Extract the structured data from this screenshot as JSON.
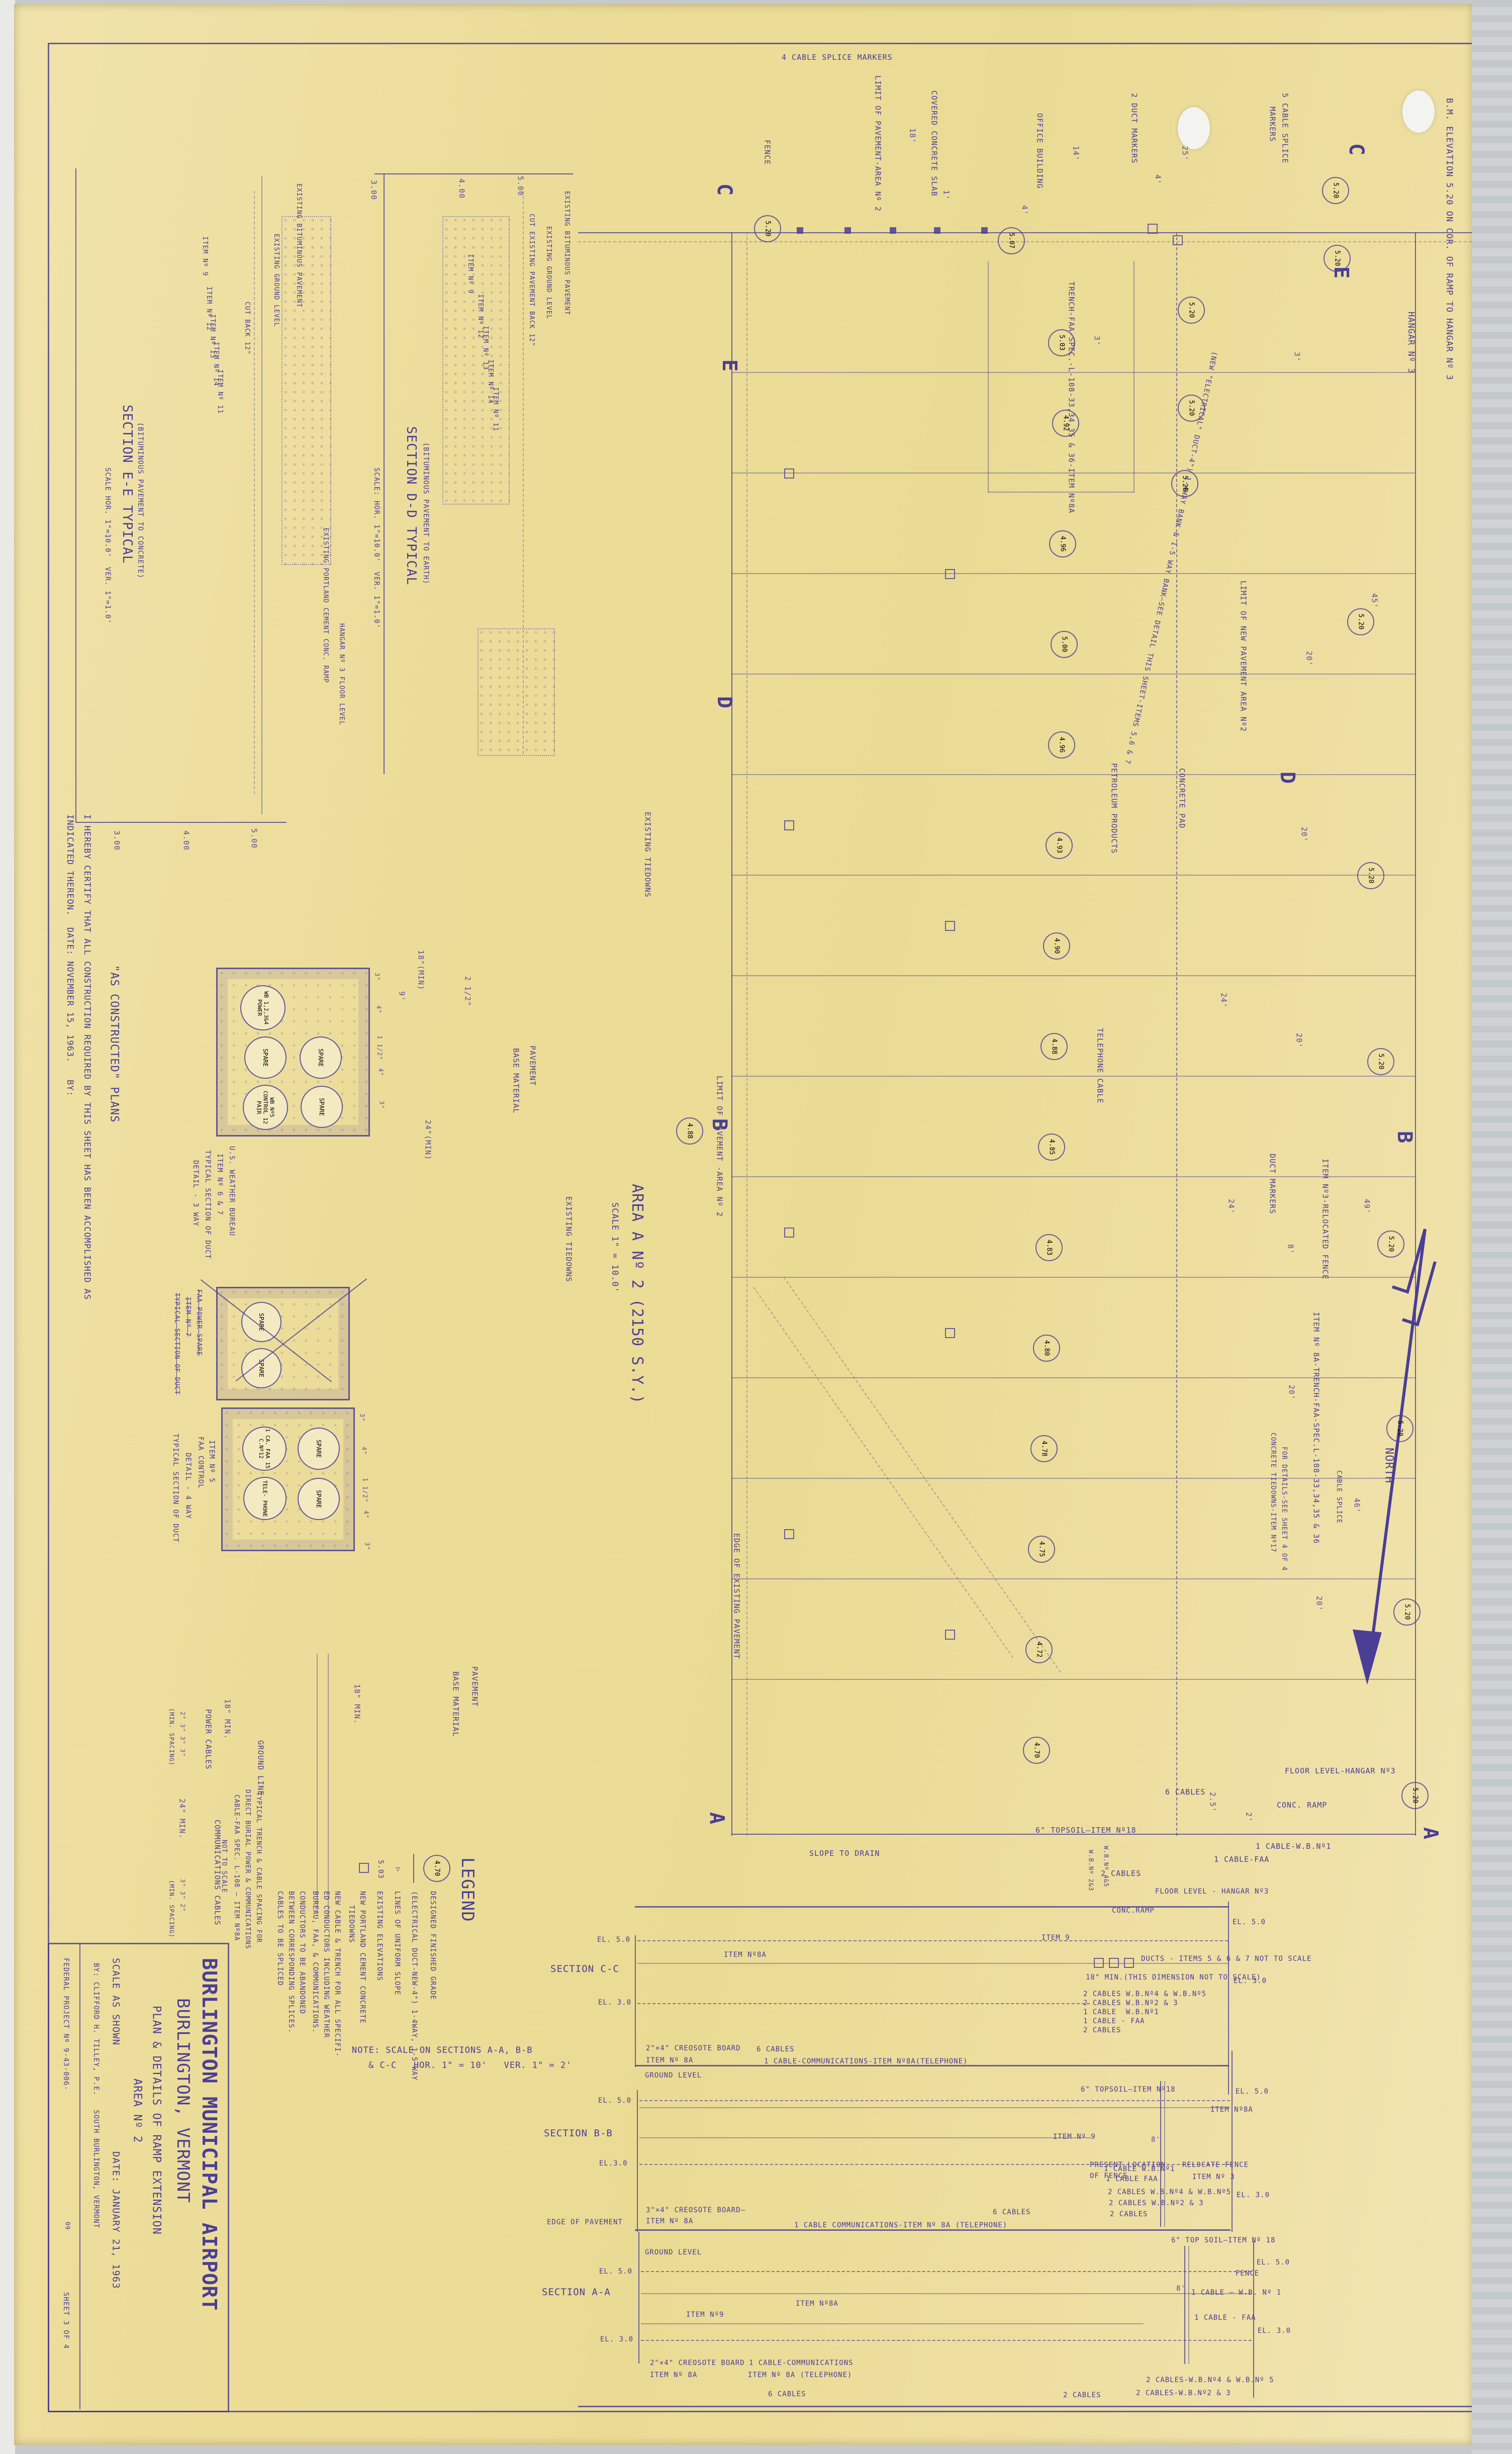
{
  "colors": {
    "paper": "#ecdc99",
    "ink": "#4a3e96",
    "scanner": "#c6c9cb"
  },
  "tb": {
    "airport": "BURLINGTON MUNICIPAL AIRPORT",
    "city": "BURLINGTON, VERMONT",
    "plan_title": "PLAN & DETAILS OF RAMP EXTENSION",
    "area": "AREA Nº 2",
    "scale": "SCALE AS SHOWN",
    "date": "DATE: JANUARY 21, 1963",
    "by": "BY: CLIFFORD H. TILLEY, P.E.   SOUTH BURLINGTON, VERMONT",
    "federal": "FEDERAL PROJECT Nº 9-43-006-",
    "fed2": "09",
    "sheet": "SHEET 3 OF 4"
  },
  "cert": {
    "line1": "I HEREBY CERTIFY THAT ALL CONSTRUCTION REQUIRED BY THIS SHEET HAS BEEN ACCOMPLISHED AS",
    "line2": "INDICATED THEREON.  DATE: NOVEMBER 15, 1963.   BY:",
    "stamp": "\"AS CONSTRUCTED\" PLANS"
  },
  "see": {
    "title": "SECTION E-E TYPICAL",
    "sub": "(BITUMINOUS PAVEMENT TO CONCRETE)",
    "scale": "SCALE HOR. 1\"=10.0'  VER. 1\"=1.0'",
    "ticks": [
      "3.00",
      "4.00",
      "5.00"
    ],
    "bitpav": "EXISTING BITUMINOUS PAVEMENT",
    "cutback": "CUT BACK 12\"",
    "ground": "EXISTING GROUND LEVEL",
    "i9": "ITEM Nº 9",
    "i12": "ITEM Nº 12",
    "i13": "ITEM Nº 13",
    "i14": "ITEM Nº 14",
    "i11": "ITEM Nº 11",
    "pccramp": "EXISTING PORTLAND CEMENT CONC. RAMP",
    "hangarfloor": "HANGAR Nº 3 FLOOR LEVEL"
  },
  "sdd": {
    "title": "SECTION D-D TYPICAL",
    "sub": "(BITUMINOUS PAVEMENT TO EARTH)",
    "scale": "SCALE: HOR. 1\"=10.0'  VER. 1\"=1.0'",
    "ticks": [
      "3.00",
      "4.00",
      "5.00"
    ],
    "bitpav": "EXISTING BITUMINOUS PAVEMENT",
    "cutpav": "CUT EXISTING PAVEMENT BACK 12\"",
    "ground": "EXISTING GROUND LEVEL",
    "i9": "ITEM Nº 9",
    "i12": "ITEM Nº 12",
    "i13": "ITEM Nº 13",
    "i14": "ITEM Nº 14",
    "i11": "ITEM Nº 11"
  },
  "ducts": {
    "wb": {
      "t1": "U.S. WEATHER BUREAU",
      "t2": "ITEM Nº 6 & 7",
      "t3": "TYPICAL SECTION OF DUCT",
      "t4": "DETAIL - 3 WAY",
      "c1": "WB 1,2,3&4 POWER",
      "c2": "SPARE",
      "c3": "WB Nº5 CONTROL 12 PAIR",
      "c4": "SPARE",
      "c5": "SPARE"
    },
    "fp": {
      "t1": "FAA POWER-SPARE",
      "t2": "ITEM Nº 7",
      "t3": "TYPICAL SECTION OF DUCT",
      "c1": "SPARE",
      "c2": "SPARE"
    },
    "fc": {
      "t1": "FAA CONTROL",
      "t2": "ITEM Nº 5",
      "t3": "TYPICAL SECTION OF DUCT",
      "t4": "DETAIL - 4 WAY",
      "c1": "1 CA. FAA 15 C.Nº12",
      "c2": "TELE- PHONE",
      "c3": "SPARE",
      "c4": "SPARE"
    },
    "pavement": "PAVEMENT",
    "base": "BASE MATERIAL",
    "min18": "18\"(MIN)",
    "min24": "24\"(MIN)",
    "d9": "9'",
    "d2h": "2 1/2\"",
    "d3": "3\"",
    "d4": "4\"",
    "d15": "1 1/2\""
  },
  "trench": {
    "power": "POWER CABLES",
    "comm": "COMMUNICATIONS CABLES",
    "ground": "GROUND LINE",
    "min18": "18\" MIN.",
    "min24": "24\" MIN.",
    "sp1": "2\" 3\" 3\" 3\"",
    "spn": "(MIN. SPACING)",
    "sp2": "3\" 3\" 2\"",
    "cap1": "TYPICAL TRENCH & CABLE SPACING FOR",
    "cap2": "DIRECT BURIAL POWER & COMMUNICATIONS",
    "cap3": "CABLE-FAA SPEC. L-108 — ITEM Nº8A",
    "cap4": "NOT TO SCALE",
    "pavement": "PAVEMENT",
    "base": "BASE MATERIAL"
  },
  "legend": {
    "title": "LEGEND",
    "i1s": "4.70",
    "i1": "DESIGNED FINISHED GRADE",
    "i2": "(ELECTRICAL DUCT-NEW-4\") 1-4WAY, 1-5 WAY",
    "i3": "LINES OF UNIFORM SLOPE",
    "i3s": "▷",
    "i4s": "5.03",
    "i4": "EXISTING ELEVATIONS",
    "i5a": "NEW PORTLAND CEMENT CONCRETE",
    "i5b": "TIEDOWNS",
    "i6a": "NEW CABLE & TRENCH FOR ALL SPECIFI-",
    "i6b": "ED CONDUCTORS INCLUDING WEATHER",
    "i6c": "BUREAU, FAA, & COMMUNICATIONS.",
    "i7a": "CONDUCTORS TO BE ABANDONED",
    "i7b": "BETWEEN CORRESPONDING SPLICES.",
    "i7c": "CABLES TO BE SPLICED",
    "note1": "NOTE: SCALE ON SECTIONS A-A, B-B",
    "note2": "& C-C   HOR. 1\" = 10'   VER. 1\" = 2'"
  },
  "scc": {
    "name": "SECTION C-C",
    "el5l": "EL. 5.0",
    "el3l": "EL. 3.0",
    "el5r": "EL. 5.0",
    "el3r": "EL. 3.0",
    "item8a": "ITEM Nº8A",
    "creo": "2\"×4\" CREOSOTE BOARD",
    "creo2": "ITEM Nº 8A",
    "c6": "6 CABLES",
    "comm": "1 CABLE-COMMUNICATIONS-ITEM Nº8A(TELEPHONE)",
    "item9": "ITEM 9",
    "ramp": "CONC.RAMP",
    "floor": "FLOOR LEVEL - HANGAR Nº3",
    "ducts": "DUCTS - ITEMS 5 & 6 & 7 NOT TO SCALE",
    "min18": "18\" MIN.(THIS DIMENSION NOT TO SCALE)",
    "k1": "2 CABLES W.B.Nº4 & W.B.Nº5",
    "k2": "2 CABLES W.B.Nº2 & 3",
    "k3": "1 CABLE  W.B.Nº1",
    "k4": "1 CABLE - FAA",
    "k5": "2 CABLES",
    "wb23": "W.B.Nº 2&3",
    "wb45": "W.B.Nº 4&5"
  },
  "sbb": {
    "name": "SECTION B-B",
    "ground": "GROUND LEVEL",
    "el5l": "EL. 5.0",
    "el3l": "EL.3.0",
    "el5r": "EL. 5.0",
    "el3r": "EL. 3.0",
    "topsoil": "6\" TOPSOIL—ITEM Nº18",
    "item8a": "ITEM Nº8A",
    "item9": "ITEM Nº 9",
    "d8": "8'",
    "pres1": "PRESENT LOCATION",
    "pres2": "OF FENCE",
    "rel1": "RELOCATE FENCE",
    "rel2": "ITEM Nº 3",
    "creo": "3\"×4\" CREOSOTE BOARD—",
    "creo2": "ITEM Nº 8A",
    "comm": "1 CABLE COMMUNICATIONS-ITEM Nº 8A (TELEPHONE)",
    "c6": "6 CABLES",
    "k1": "1 CABLE W.B.Nº1",
    "k2": "1 CABLE FAA",
    "k3": "2 CABLES W.B.Nº4 & W.B.Nº5",
    "k4": "2 CABLES W.B.Nº2 & 3",
    "k5": "2 CABLES"
  },
  "saa": {
    "name": "SECTION A-A",
    "edge": "EDGE OF PAVEMENT",
    "ground": "GROUND LEVEL",
    "el5l": "EL. 5.0",
    "el3l": "EL. 3.0",
    "el5r": "EL. 5.0",
    "el3r": "EL. 3.0",
    "item9": "ITEM Nº9",
    "item8a": "ITEM Nº8A",
    "creo": "2\"×4\" CREOSOTE BOARD",
    "creo2": "ITEM Nº 8A",
    "comm1": "1 CABLE-COMMUNICATIONS",
    "comm2": "ITEM Nº 8A (TELEPHONE)",
    "c6": "6 CABLES",
    "topsoil": "6\" TOP SOIL—ITEM Nº 18",
    "fence": "FENCE",
    "d8": "8'",
    "kwb1": "1 CABLE — W.B. Nº 1",
    "kfaa": "1 CABLE - FAA",
    "k45": "2 CABLES-W.B.Nº4 & W.B.Nº 5",
    "k23": "2 CABLES-W.B.Nº2 & 3",
    "k2": "2 CABLES"
  },
  "plan": {
    "title": "AREA A Nº 2 (2150 S.Y.)",
    "scale": "SCALE 1\" = 10.0'",
    "splice4": "4 CABLE SPLICE MARKERS",
    "splice5a": "5 CABLE SPLICE",
    "splice5b": "MARKERS",
    "bm": "B.M. ELEVATION 5.20 ON COR. OF RAMP TO HANGAR Nº 3",
    "hangar": "HANGAR Nº 3",
    "north": "NORTH",
    "cuts": {
      "c": "C",
      "e": "E",
      "d": "D",
      "b": "B",
      "a": "A"
    },
    "labels": {
      "fence": "FENCE",
      "limit_pav": "LIMIT OF PAVEMENT-AREA Nº 2",
      "limit_pav2": "LIMIT OF PAVEMENT -AREA Nº 2",
      "limit_new": "LIMIT OF NEW PAVEMENT AREA Nº2",
      "slab": "COVERED CONCRETE SLAB",
      "office": "OFFICE BUILDING",
      "ductm2": "2 DUCT MARKERS",
      "ductm": "DUCT MARKERS",
      "trench": "TRENCH-FAA-SPEC.-L-108-33,34,35 & 36-ITEM Nº8A",
      "newduct": "(NEW \"ELECTRICAL\" DUCT-4\") 1-4WAY BANK & 1-5 WAY BANK—SEE DETAIL THIS SHEET-ITEMS 5,6 & 7",
      "item8a_trench": "ITEM Nº 8A-TRENCH-FAA-SPEC.L-108-33,34,35 & 36",
      "petroleum": "PETROLEUM PRODUCTS",
      "pad": "CONCRETE PAD",
      "relocated": "ITEM Nº3-RELOCATED FENCE",
      "tiedowns": "EXISTING TIEDOWNS",
      "tiedowns2": "EXISTING TIEDOWNS",
      "edge_exist": "EDGE OF EXISTING PAVEMENT",
      "telcable": "TELEPHONE CABLE",
      "ctiedowns": "CONCRETE TIEDOWNS-ITEM Nº17",
      "ctiedowns2": "FOR DETAILS-SEE SHEET 4 OF 4",
      "csplice": "CABLE SPLICE",
      "slope": "SLOPE TO DRAIN",
      "topsoil": "6\" TOPSOIL—ITEM Nº18",
      "c6": "6 CABLES",
      "c2": "2 CABLES",
      "cfaa": "1 CABLE-FAA",
      "cwb1": "1 CABLE-W.B.Nº1",
      "ramp": "CONC. RAMP",
      "floor": "FLOOR LEVEL-HANGAR Nº3"
    },
    "dims": {
      "d18": "18'",
      "d14": "14'",
      "d1": "1'",
      "d4": "4'",
      "d3": "3'",
      "d3b": "3'",
      "d25": "25'",
      "d4b": "4'",
      "d49": "49'",
      "d8": "8'",
      "d20": "20'",
      "d20b": "20'",
      "d20c": "20'",
      "d20d": "20'",
      "d20e": "20'",
      "d24": "24'",
      "d24b": "24'",
      "d46": "46'",
      "d45": "45'",
      "d2": "2'",
      "d2h": "2.5'"
    },
    "elevations": [
      "5.20",
      "5.07",
      "5.20",
      "5.20",
      "5.20",
      "5.03",
      "5.20",
      "4.92",
      "5.20",
      "4.96",
      "5.00",
      "4.96",
      "4.93",
      "4.90",
      "4.88",
      "4.85",
      "4.83",
      "4.80",
      "4.78",
      "4.75",
      "4.72",
      "4.70",
      "5.20",
      "5.20",
      "5.20",
      "5.20",
      "5.20",
      "5.20",
      "5.20",
      "4.88"
    ]
  }
}
